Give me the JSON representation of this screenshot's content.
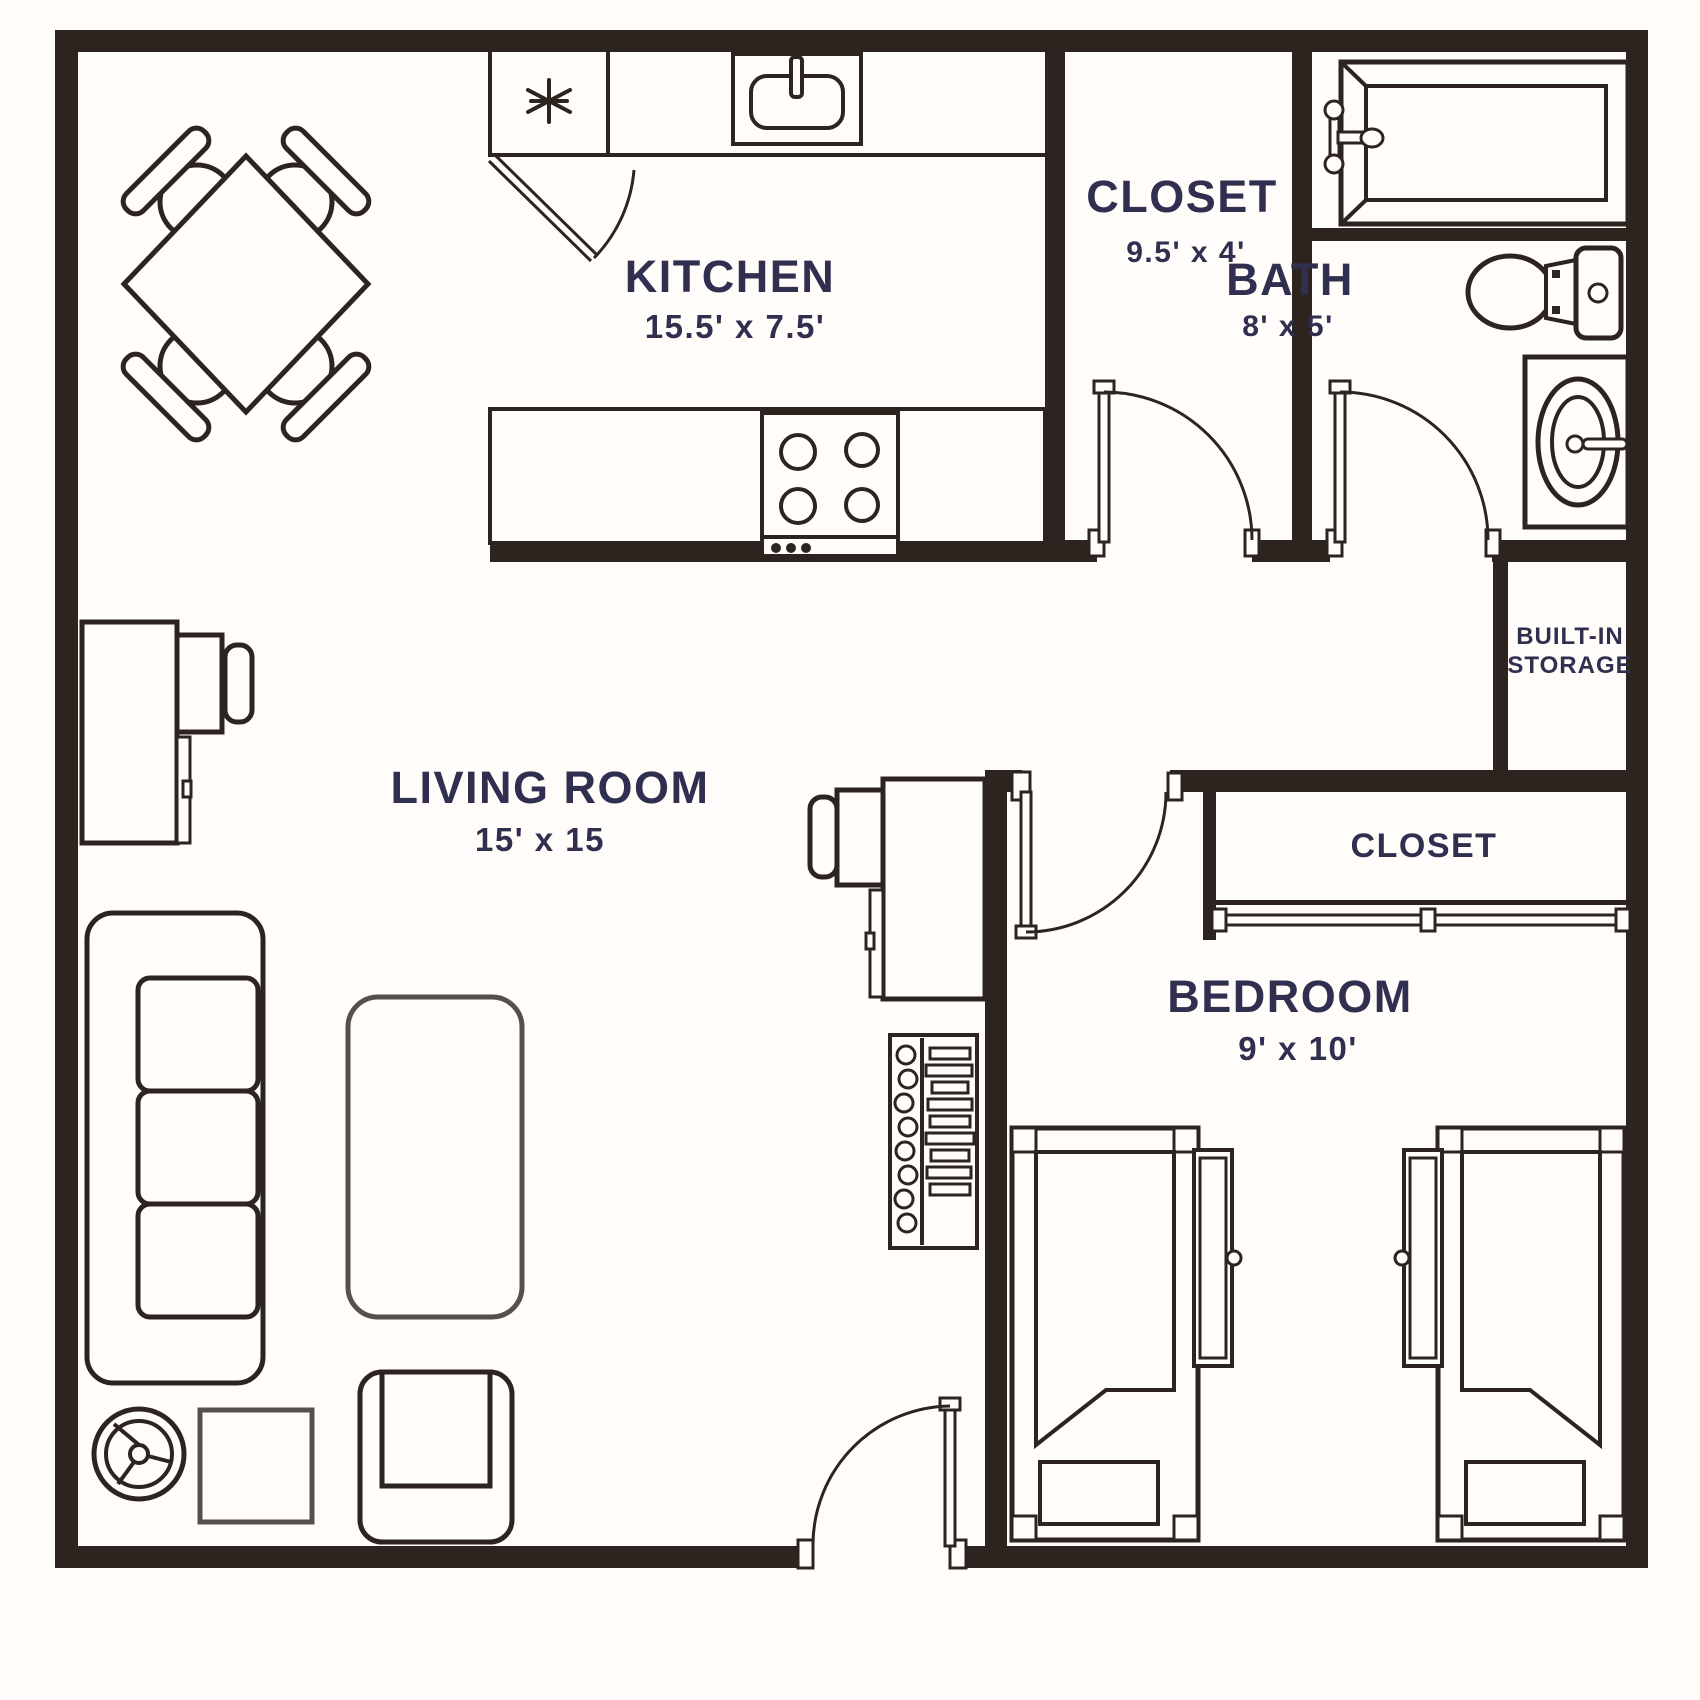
{
  "plan": {
    "colors": {
      "background": "#fffcfa",
      "wall": "#2d2420",
      "label": "#312f4f",
      "light_furniture": "#55504b"
    },
    "rooms": {
      "kitchen": {
        "label": "KITCHEN",
        "dims": "15.5' x 7.5'"
      },
      "closet_top": {
        "label": "CLOSET",
        "dims": "9.5' x 4'"
      },
      "bath": {
        "label": "BATH",
        "dims": "8' x 5'"
      },
      "living_room": {
        "label": "LIVING ROOM",
        "dims": "15' x 15"
      },
      "built_in_storage": {
        "label_line1": "BUILT-IN",
        "label_line2": "STORAGE"
      },
      "bedroom_closet": {
        "label": "CLOSET"
      },
      "bedroom": {
        "label": "BEDROOM",
        "dims": "9' x 10'"
      }
    }
  }
}
